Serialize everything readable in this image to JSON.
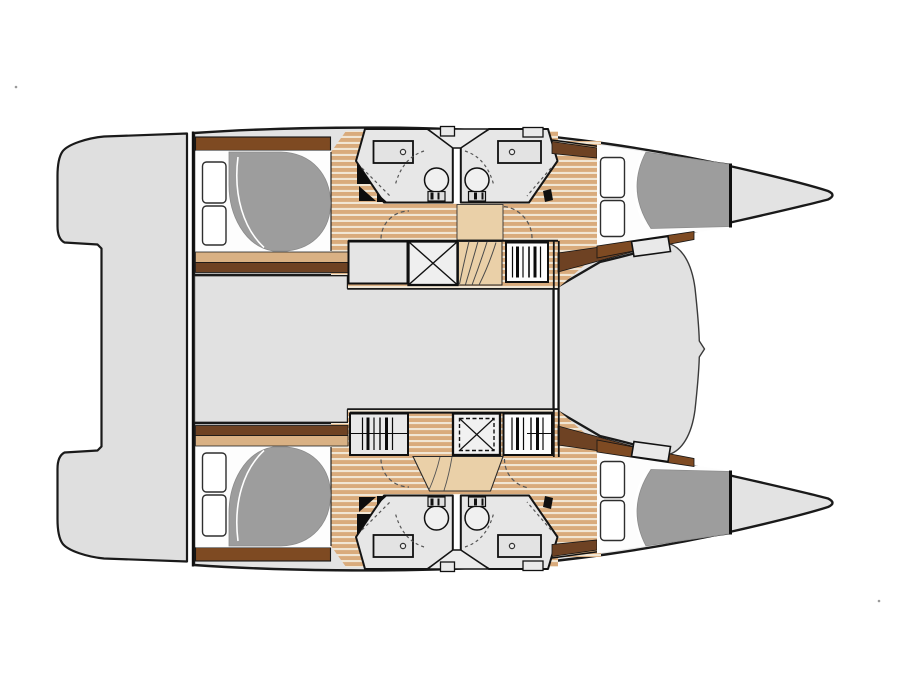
{
  "meta": {
    "type": "boat-deck-plan",
    "subject": "catamaran interior layout, top-down view, no text labels"
  },
  "colors": {
    "background": "#ffffff",
    "outline": "#1a1a1a",
    "hull": "#e3e3e3",
    "platform": "#dfdfdf",
    "deck": "#e1e1e1",
    "bathroom": "#e7e7e7",
    "vestibule": "#ececec",
    "mattress": "#fdfdfd",
    "pillow": "#ffffff",
    "bedspread": "#9d9d9d",
    "wood_dark": "#d9ab7c",
    "wood_light": "#f1e6d4",
    "band_tan": "#d9b184",
    "brown_dark": "#6e4223",
    "brown_mid": "#7e4a22",
    "stair_tan": "#ead0a8",
    "hatch": "#e9e9e9",
    "fixture": "#e3e3e3",
    "dash_line": "#555555"
  },
  "features": {
    "areas": [
      "stern-platform",
      "bridgedeck-saloon",
      "foredeck",
      "bow-locker"
    ],
    "hulls": [
      {
        "name": "port hull",
        "rooms": [
          "aft double cabin",
          "bathroom",
          "bathroom",
          "forward double cabin"
        ]
      },
      {
        "name": "starboard hull",
        "rooms": [
          "aft double cabin",
          "bathroom",
          "bathroom",
          "forward double cabin"
        ]
      }
    ],
    "icons": [
      "double-bed",
      "pillow",
      "toilet",
      "washbasin",
      "shower-box",
      "hanging-locker",
      "staircase",
      "deck-hatch",
      "door-swing"
    ]
  }
}
